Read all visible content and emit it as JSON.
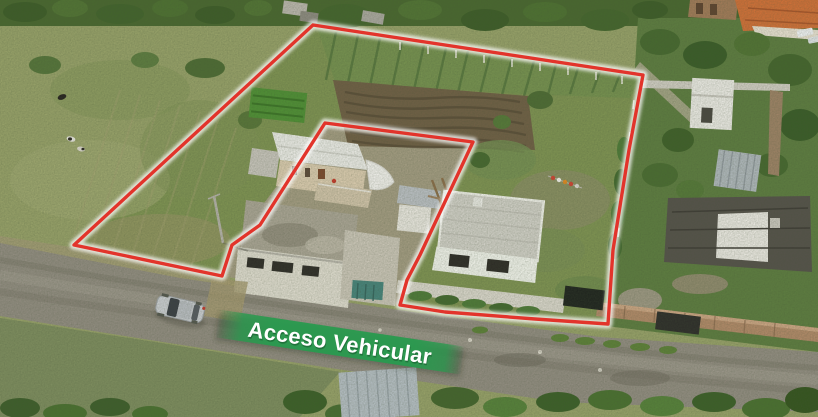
{
  "banner": {
    "label": "Acceso Vehicular",
    "background_color": "#2a9a4f",
    "text_color": "#ffffff"
  },
  "boundary": {
    "stroke_color": "#e2342b",
    "glow_color": "#ffffff"
  }
}
